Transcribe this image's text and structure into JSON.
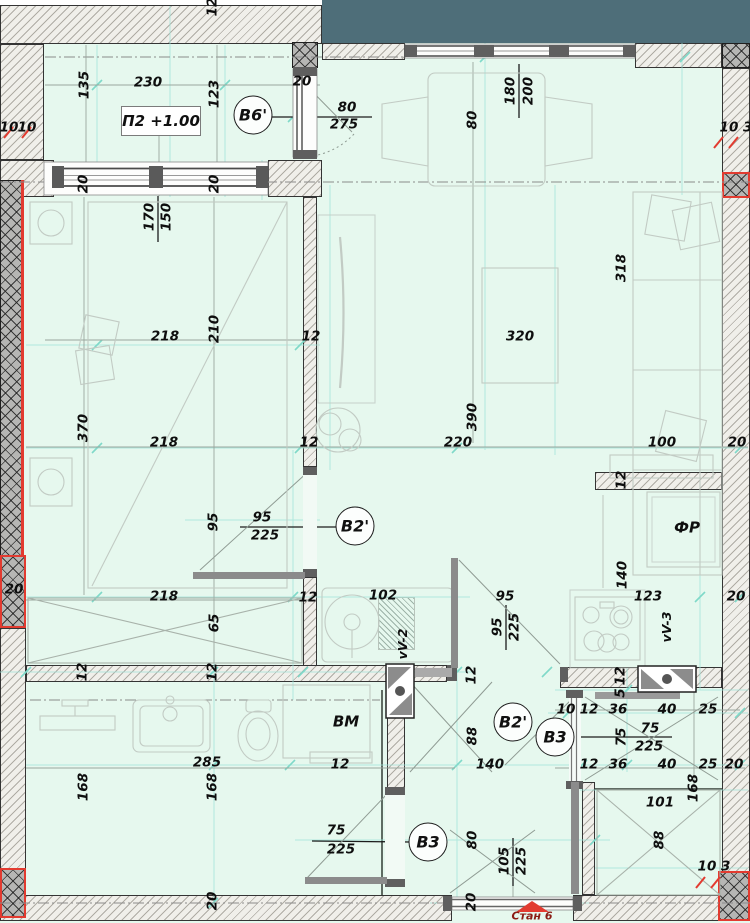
{
  "plan": {
    "level_tag": "П2 +1.00",
    "apartment_label": "Стан 6",
    "colors": {
      "background_mint": "#e6f8ee",
      "facade_teal": "#4e6e79",
      "accent_red": "#e23b30",
      "construction_cyan": "#9fe3d8",
      "wall_line": "#343434"
    },
    "markers": [
      {
        "text": "В6'",
        "x": 253,
        "y": 115
      },
      {
        "text": "В2'",
        "x": 355,
        "y": 526
      },
      {
        "text": "В2'",
        "x": 513,
        "y": 722
      },
      {
        "text": "В3",
        "x": 555,
        "y": 737
      },
      {
        "text": "В3",
        "x": 428,
        "y": 842
      }
    ],
    "labels": [
      {
        "t": "12",
        "x": 213,
        "y": 7,
        "r": 1
      },
      {
        "t": "135",
        "x": 85,
        "y": 85,
        "r": 1
      },
      {
        "t": "230",
        "x": 148,
        "y": 83
      },
      {
        "t": "123",
        "x": 215,
        "y": 94,
        "r": 1
      },
      {
        "t": "20",
        "x": 302,
        "y": 82
      },
      {
        "t": "80",
        "x": 347,
        "y": 108
      },
      {
        "t": "275",
        "x": 344,
        "y": 125
      },
      {
        "t": "10",
        "x": 9,
        "y": 128
      },
      {
        "t": "10",
        "x": 27,
        "y": 128
      },
      {
        "t": "10 3",
        "x": 736,
        "y": 128
      },
      {
        "t": "180",
        "x": 511,
        "y": 91,
        "r": 1
      },
      {
        "t": "200",
        "x": 529,
        "y": 91,
        "r": 1
      },
      {
        "t": "80",
        "x": 473,
        "y": 120,
        "r": 1
      },
      {
        "t": "20",
        "x": 84,
        "y": 184,
        "r": 1
      },
      {
        "t": "20",
        "x": 215,
        "y": 184,
        "r": 1
      },
      {
        "t": "170",
        "x": 150,
        "y": 217,
        "r": 1
      },
      {
        "t": "150",
        "x": 167,
        "y": 217,
        "r": 1
      },
      {
        "t": "218",
        "x": 165,
        "y": 337
      },
      {
        "t": "210",
        "x": 215,
        "y": 329,
        "r": 1
      },
      {
        "t": "12",
        "x": 311,
        "y": 337
      },
      {
        "t": "370",
        "x": 84,
        "y": 428,
        "r": 1
      },
      {
        "t": "218",
        "x": 164,
        "y": 443
      },
      {
        "t": "12",
        "x": 309,
        "y": 443
      },
      {
        "t": "318",
        "x": 622,
        "y": 268,
        "r": 1
      },
      {
        "t": "320",
        "x": 520,
        "y": 337
      },
      {
        "t": "390",
        "x": 473,
        "y": 417,
        "r": 1
      },
      {
        "t": "220",
        "x": 458,
        "y": 443
      },
      {
        "t": "100",
        "x": 662,
        "y": 443
      },
      {
        "t": "20",
        "x": 737,
        "y": 443
      },
      {
        "t": "95",
        "x": 214,
        "y": 522,
        "r": 1
      },
      {
        "t": "95",
        "x": 262,
        "y": 518
      },
      {
        "t": "225",
        "x": 265,
        "y": 536
      },
      {
        "t": "12",
        "x": 308,
        "y": 598
      },
      {
        "t": "102",
        "x": 383,
        "y": 596
      },
      {
        "t": "vV-2",
        "x": 403,
        "y": 644,
        "r": 1,
        "fs": 12.5
      },
      {
        "t": "65",
        "x": 215,
        "y": 623,
        "r": 1
      },
      {
        "t": "218",
        "x": 164,
        "y": 597
      },
      {
        "t": "20",
        "x": 14,
        "y": 590
      },
      {
        "t": "12",
        "x": 83,
        "y": 672,
        "r": 1
      },
      {
        "t": "12",
        "x": 213,
        "y": 672,
        "r": 1
      },
      {
        "t": "95",
        "x": 505,
        "y": 597
      },
      {
        "t": "95",
        "x": 498,
        "y": 627,
        "r": 1
      },
      {
        "t": "225",
        "x": 515,
        "y": 627,
        "r": 1
      },
      {
        "t": "12",
        "x": 472,
        "y": 675,
        "r": 1
      },
      {
        "t": "88",
        "x": 473,
        "y": 736,
        "r": 1
      },
      {
        "t": "140",
        "x": 490,
        "y": 765
      },
      {
        "t": "12",
        "x": 622,
        "y": 480,
        "r": 1
      },
      {
        "t": "ФР",
        "x": 687,
        "y": 528,
        "fs": 15
      },
      {
        "t": "140",
        "x": 623,
        "y": 575,
        "r": 1
      },
      {
        "t": "123",
        "x": 648,
        "y": 597
      },
      {
        "t": "20",
        "x": 736,
        "y": 597
      },
      {
        "t": "vV-3",
        "x": 667,
        "y": 627,
        "r": 1,
        "fs": 12.5
      },
      {
        "t": "12",
        "x": 621,
        "y": 676,
        "r": 1
      },
      {
        "t": "5",
        "x": 621,
        "y": 693,
        "r": 1
      },
      {
        "t": "10",
        "x": 566,
        "y": 710
      },
      {
        "t": "12",
        "x": 589,
        "y": 710
      },
      {
        "t": "36",
        "x": 618,
        "y": 710
      },
      {
        "t": "40",
        "x": 667,
        "y": 710
      },
      {
        "t": "25",
        "x": 708,
        "y": 710
      },
      {
        "t": "75",
        "x": 622,
        "y": 737,
        "r": 1
      },
      {
        "t": "75",
        "x": 650,
        "y": 729
      },
      {
        "t": "225",
        "x": 649,
        "y": 747
      },
      {
        "t": "12",
        "x": 589,
        "y": 765
      },
      {
        "t": "36",
        "x": 618,
        "y": 765
      },
      {
        "t": "40",
        "x": 667,
        "y": 765
      },
      {
        "t": "25",
        "x": 708,
        "y": 765
      },
      {
        "t": "20",
        "x": 734,
        "y": 765
      },
      {
        "t": "168",
        "x": 694,
        "y": 788,
        "r": 1
      },
      {
        "t": "101",
        "x": 660,
        "y": 803
      },
      {
        "t": "88",
        "x": 660,
        "y": 840,
        "r": 1
      },
      {
        "t": "10 3",
        "x": 714,
        "y": 867
      },
      {
        "t": "ВМ",
        "x": 346,
        "y": 722,
        "fs": 15
      },
      {
        "t": "12",
        "x": 340,
        "y": 765
      },
      {
        "t": "75",
        "x": 336,
        "y": 831
      },
      {
        "t": "225",
        "x": 341,
        "y": 850
      },
      {
        "t": "80",
        "x": 473,
        "y": 840,
        "r": 1
      },
      {
        "t": "105",
        "x": 505,
        "y": 861,
        "r": 1
      },
      {
        "t": "225",
        "x": 522,
        "y": 861,
        "r": 1
      },
      {
        "t": "20",
        "x": 472,
        "y": 902,
        "r": 1
      },
      {
        "t": "168",
        "x": 84,
        "y": 787,
        "r": 1
      },
      {
        "t": "285",
        "x": 207,
        "y": 763
      },
      {
        "t": "168",
        "x": 213,
        "y": 787,
        "r": 1
      },
      {
        "t": "20",
        "x": 213,
        "y": 901,
        "r": 1
      }
    ]
  }
}
